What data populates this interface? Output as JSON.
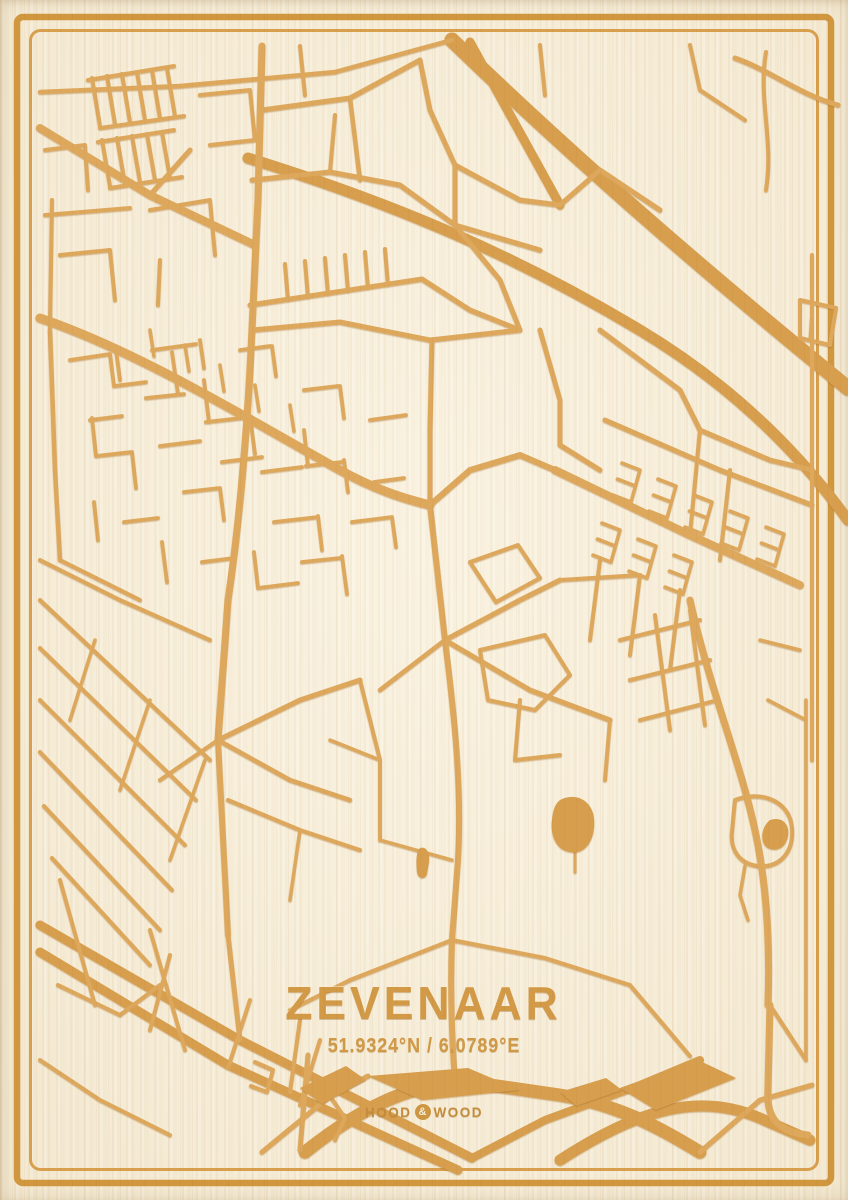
{
  "poster": {
    "title": "ZEVENAAR",
    "coordinates": "51.9324°N / 6.0789°E",
    "brand": {
      "left": "HOOD",
      "amp": "&",
      "right": "WOOD"
    }
  },
  "colors": {
    "wood_bg": "#f6eedb",
    "engrave": "#dda85c",
    "engrave_deep": "#d69e4e",
    "frame_outer": "#d0973f",
    "frame_inner": "#d8a04d",
    "text": "#d29a47"
  },
  "frame": {
    "outer": {
      "inset": 17,
      "width": 6.5,
      "radius": 6
    },
    "inner": {
      "inset": 30.5,
      "width": 3,
      "radius": 10
    }
  },
  "map": {
    "viewbox": [
      0,
      0,
      848,
      1200
    ],
    "roads": [
      {
        "d": "M452,40 C540,125 660,235 848,388",
        "w": 15,
        "deep": true
      },
      {
        "d": "M248,158 C400,205 520,258 640,330 C720,378 790,440 848,520",
        "w": 11,
        "deep": true
      },
      {
        "d": "M470,42 L560,205",
        "w": 9,
        "deep": true
      },
      {
        "d": "M40,925 L240,1040 L472,1158",
        "w": 9,
        "deep": true
      },
      {
        "d": "M40,952 L228,1065 L458,1170",
        "w": 9,
        "deep": true
      },
      {
        "d": "M305,1152 C370,1100 420,1082 470,1082 L560,1095 C620,1105 660,1128 700,1152",
        "w": 13,
        "deep": true
      },
      {
        "d": "M560,1160 C640,1108 700,1092 760,1118 L810,1140",
        "w": 11,
        "deep": true
      },
      {
        "d": "M472,1158 L545,1120 L640,1085 L700,1060",
        "w": 8,
        "deep": true
      },
      {
        "d": "M770,1005 L768,1090 C766,1120 780,1132 808,1135",
        "w": 7
      },
      {
        "d": "M262,1152 L330,1096 L368,1076",
        "w": 5
      },
      {
        "d": "M330,1096 L345,1118 L335,1140",
        "w": 4
      },
      {
        "d": "M700,1152 L760,1100 L812,1085",
        "w": 5
      },
      {
        "d": "M308,1055 L300,1150",
        "w": 5
      },
      {
        "d": "M40,92 L180,86 L335,72",
        "w": 4.5
      },
      {
        "d": "M335,72 L452,40",
        "w": 4.5
      },
      {
        "d": "M40,128 L150,195 L255,245",
        "w": 8
      },
      {
        "d": "M150,195 L190,150",
        "w": 5
      },
      {
        "d": "M92,78 l8,48 M107,76 l8,48 M122,74 l8,48 M137,72 l8,48 M152,70 l8,48 M167,68 l8,48",
        "w": 4
      },
      {
        "d": "M88,80 l86,-14 M100,128 l84,-12",
        "w": 4
      },
      {
        "d": "M102,140 l8,46 M117,138 l8,46 M132,136 l8,46 M147,134 l8,46 M162,132 l8,46",
        "w": 4
      },
      {
        "d": "M98,142 l76,-12 M110,188 l72,-11",
        "w": 4
      },
      {
        "d": "M45,150 L85,145 L88,190",
        "w": 4
      },
      {
        "d": "M45,215 L130,208",
        "w": 4
      },
      {
        "d": "M150,210 L210,200 L215,255",
        "w": 4
      },
      {
        "d": "M60,255 L110,250 L115,300",
        "w": 4
      },
      {
        "d": "M160,260 L158,305",
        "w": 4
      },
      {
        "d": "M200,95 L250,90 L255,140",
        "w": 4
      },
      {
        "d": "M210,145 L255,140",
        "w": 4
      },
      {
        "d": "M262,46 L258,200 L252,330",
        "w": 7
      },
      {
        "d": "M262,110 L350,98 L420,60",
        "w": 5
      },
      {
        "d": "M350,98 L360,180",
        "w": 4.5
      },
      {
        "d": "M300,46 L305,95",
        "w": 4
      },
      {
        "d": "M252,180 L330,172 L400,185 L455,225",
        "w": 5
      },
      {
        "d": "M330,172 L335,115",
        "w": 4
      },
      {
        "d": "M420,60 L430,110 L455,165 L455,225",
        "w": 5
      },
      {
        "d": "M455,165 L520,200 L560,205",
        "w": 5
      },
      {
        "d": "M455,225 L500,280 L520,330",
        "w": 5
      },
      {
        "d": "M455,225 L540,250",
        "w": 5
      },
      {
        "d": "M250,305 L422,279",
        "w": 5
      },
      {
        "d": "M285,264 l3,36 M305,261 l3,36 M325,258 l3,36 M345,255 l3,36 M365,252 l3,36 M385,249 l3,36",
        "w": 4
      },
      {
        "d": "M422,279 L470,310 L520,330",
        "w": 5
      },
      {
        "d": "M540,45 L545,95",
        "w": 4
      },
      {
        "d": "M560,205 L600,170 L660,210",
        "w": 5
      },
      {
        "d": "M690,45 L700,90 L745,120",
        "w": 4
      },
      {
        "d": "M766,52 C758,100 774,140 766,190",
        "w": 4
      },
      {
        "d": "M800,300 L836,308 L830,345 L800,338 Z",
        "w": 4
      },
      {
        "d": "M812,308 L810,340",
        "w": 3
      },
      {
        "d": "M812,255 L812,760",
        "w": 4
      },
      {
        "d": "M600,330 L680,390 L700,430",
        "w": 5
      },
      {
        "d": "M540,330 L560,400 L560,445",
        "w": 5
      },
      {
        "d": "M700,430 L770,460 L812,470",
        "w": 5
      },
      {
        "d": "M40,318 C140,352 250,420 340,470 C380,492 410,500 430,505",
        "w": 9
      },
      {
        "d": "M52,200 L50,330",
        "w": 4
      },
      {
        "d": "M50,330 L55,470 L60,560",
        "w": 4.5
      },
      {
        "d": "M252,330 L340,322 L430,340 L520,330",
        "w": 5
      },
      {
        "d": "M432,340 L430,430 L430,505",
        "w": 5
      },
      {
        "d": "M430,505 L470,470 L520,455 L555,470",
        "w": 6
      },
      {
        "d": "M555,470 L690,535 L800,585",
        "w": 8
      },
      {
        "d": "M605,420 L720,470 L812,505",
        "w": 5
      },
      {
        "d": "M560,445 L600,470",
        "w": 5
      },
      {
        "d": "M700,430 L690,535",
        "w": 4
      },
      {
        "d": "M730,470 L720,560",
        "w": 4
      },
      {
        "d": "M640,470 l-9,32 M640,470 l-18,-7 M635.5,486 l-18,-7 M631,502 l-18,-7",
        "w": 3.5
      },
      {
        "d": "M676,486 l-9,32 M676,486 l-18,-7 M671.5,502 l-18,-7 M667,518 l-18,-7",
        "w": 3.5
      },
      {
        "d": "M712,502 l-9,32 M712,502 l-18,-7 M707.5,518 l-18,-7 M703,534 l-18,-7",
        "w": 3.5
      },
      {
        "d": "M748,518 l-9,32 M748,518 l-18,-7 M743.5,534 l-18,-7 M739,550 l-18,-7",
        "w": 3.5
      },
      {
        "d": "M784,534 l-9,32 M784,534 l-18,-7 M779.5,550 l-18,-7 M775,566 l-18,-7",
        "w": 3.5
      },
      {
        "d": "M620,530 l-9,32 M620,530 l-18,-7 M615.5,546 l-18,-7 M611,562 l-18,-7",
        "w": 3.5
      },
      {
        "d": "M656,546 l-9,32 M656,546 l-18,-7 M651.5,562 l-18,-7 M647,578 l-18,-7",
        "w": 3.5
      },
      {
        "d": "M692,562 l-9,32 M692,562 l-18,-7 M687.5,578 l-18,-7 M683,594 l-18,-7",
        "w": 3.5
      },
      {
        "d": "M600,560 L590,640",
        "w": 4
      },
      {
        "d": "M640,575 L630,655",
        "w": 4
      },
      {
        "d": "M680,590 L670,670",
        "w": 4
      },
      {
        "d": "M70,360 l40,-6 M110,354 l4,32 M114,386 l32,-4 M152,350 l44,-6 M172,352 l6,42 M146,398 l38,-4",
        "w": 3.8
      },
      {
        "d": "M90,420 l32,-4 M92,418 l4,38 M96,456 l36,-4 M132,452 l4,36 M160,446 l40,-5 M204,380 l5,42 M206,422 l44,-5",
        "w": 3.8
      },
      {
        "d": "M250,416 l5,38 M222,462 l40,-5 M184,492 l36,-4 M220,488 l4,32 M262,472 l40,-5 M304,430 l4,36 M306,466 l36,-4",
        "w": 3.8
      },
      {
        "d": "M344,460 l4,32 M274,522 l44,-5 M318,516 l4,34 M254,552 l4,36 M258,588 l40,-5 M302,562 l38,-4 M342,556 l5,38",
        "w": 3.8
      },
      {
        "d": "M202,562 l32,-4 M162,542 l5,40 M124,522 l34,-4 M94,502 l4,38 M352,522 l40,-5 M392,517 l4,30 M374,482 l30,-4",
        "w": 3.8
      },
      {
        "d": "M120,380 l-4,-30 M240,350 l30,-4 M272,346 l4,30 M200,340 l4,28 M304,390 l34,-4 M340,386 l4,32 M370,420 l36,-5",
        "w": 3.8
      },
      {
        "d": "M150,330 l4,26 M185,345 l4,26 M220,365 l4,26 M255,385 l4,26 M290,405 l4,26",
        "w": 3.5
      },
      {
        "d": "M252,330 C248,420 240,520 228,600 L218,740",
        "w": 7
      },
      {
        "d": "M218,740 L228,935",
        "w": 6
      },
      {
        "d": "M228,935 L240,1040",
        "w": 5
      },
      {
        "d": "M218,740 L300,700 L360,680",
        "w": 5
      },
      {
        "d": "M218,740 L290,780 L350,800",
        "w": 4.5
      },
      {
        "d": "M218,740 L160,780",
        "w": 4
      },
      {
        "d": "M60,560 L140,600",
        "w": 4
      },
      {
        "d": "M40,560 L120,600 L210,640",
        "w": 4
      },
      {
        "d": "M40,600 L210,760",
        "w": 4
      },
      {
        "d": "M40,648 L196,800",
        "w": 4
      },
      {
        "d": "M40,700 L185,845",
        "w": 4
      },
      {
        "d": "M40,752 L172,890",
        "w": 4
      },
      {
        "d": "M44,806 L160,930",
        "w": 4
      },
      {
        "d": "M52,858 L150,965",
        "w": 4
      },
      {
        "d": "M95,640 L70,720",
        "w": 3.5
      },
      {
        "d": "M150,700 L120,790",
        "w": 3.5
      },
      {
        "d": "M205,760 L170,860",
        "w": 3.5
      },
      {
        "d": "M430,505 L445,640",
        "w": 6
      },
      {
        "d": "M445,640 L520,600 L560,580",
        "w": 5
      },
      {
        "d": "M445,640 L530,690 L610,720",
        "w": 5
      },
      {
        "d": "M445,640 L380,690",
        "w": 4.5
      },
      {
        "d": "M445,640 C455,720 462,790 458,860 L452,940 C450,990 452,1040 455,1082",
        "w": 6
      },
      {
        "d": "M470,562 L518,545 L540,578 L496,602 Z",
        "w": 4
      },
      {
        "d": "M480,650 L545,635 L570,675 L535,710 L488,700 Z",
        "w": 4
      },
      {
        "d": "M520,700 L515,760 M515,760 L560,755",
        "w": 4
      },
      {
        "d": "M610,720 L605,780",
        "w": 4
      },
      {
        "d": "M560,580 L640,575",
        "w": 4
      },
      {
        "d": "M575,852 L575,872",
        "w": 3
      },
      {
        "d": "M690,600 C710,690 740,760 755,830 C768,890 770,950 768,1005",
        "w": 7
      },
      {
        "d": "M620,640 L700,620 M630,680 L710,660 M640,720 L718,700",
        "w": 4
      },
      {
        "d": "M655,615 L670,730 M690,610 L705,725",
        "w": 4
      },
      {
        "d": "M735,800 C760,790 790,800 792,828 C794,852 780,868 758,866 C740,864 730,850 732,832 Z",
        "w": 4
      },
      {
        "d": "M745,866 L740,895 L748,920",
        "w": 3.5
      },
      {
        "d": "M806,700 L806,1060",
        "w": 3.5
      },
      {
        "d": "M770,1005 L806,1060",
        "w": 4
      },
      {
        "d": "M768,700 L806,720 M760,640 L800,650",
        "w": 3.5
      },
      {
        "d": "M150,930 L185,1050",
        "w": 4
      },
      {
        "d": "M60,880 L95,1005",
        "w": 4
      },
      {
        "d": "M58,985 L120,1015 M120,1015 L160,985",
        "w": 4
      },
      {
        "d": "M170,955 L150,1030",
        "w": 4
      },
      {
        "d": "M250,1000 L228,1068",
        "w": 4
      },
      {
        "d": "M320,1040 L300,1105",
        "w": 4
      },
      {
        "d": "M40,1060 L100,1100 L170,1135",
        "w": 4
      },
      {
        "d": "M350,980 L452,940",
        "w": 4
      },
      {
        "d": "M452,940 L545,958 L630,985",
        "w": 4
      },
      {
        "d": "M630,985 L690,1056",
        "w": 4
      },
      {
        "d": "M290,1010 L350,980",
        "w": 4
      },
      {
        "d": "M300,1020 L290,1092",
        "w": 4
      },
      {
        "d": "M228,800 L300,830 L360,850",
        "w": 4
      },
      {
        "d": "M300,830 L290,900",
        "w": 3.5
      },
      {
        "d": "M360,680 L380,760 L380,840",
        "w": 4
      },
      {
        "d": "M380,840 L452,860",
        "w": 3.5
      },
      {
        "d": "M330,740 L380,760",
        "w": 3.5
      },
      {
        "d": "M735,58 C770,70 800,95 838,105",
        "w": 5
      },
      {
        "d": "M255,1062 l18,8 l-6,22 l-16,-6",
        "w": 4
      }
    ],
    "fills": [
      {
        "d": "M560,800 C575,792 592,800 594,818 C596,840 585,855 570,852 C556,850 550,835 552,820 C553,810 555,804 560,800 Z"
      },
      {
        "d": "M770,820 C782,816 790,824 788,836 C786,848 776,852 768,848 C760,844 760,828 770,820 Z"
      },
      {
        "d": "M420,848 C426,846 430,852 429,862 L427,874 C425,880 418,879 417,872 C416,862 416,852 420,848 Z"
      },
      {
        "d": "M368,1076 L468,1068 L520,1090 L422,1100 Z"
      },
      {
        "d": "M620,1088 L698,1060 L736,1078 L656,1110 Z"
      },
      {
        "d": "M300,1088 L346,1066 L366,1080 L322,1104 Z"
      },
      {
        "d": "M560,1092 L606,1078 L622,1090 L576,1106 Z"
      }
    ]
  }
}
